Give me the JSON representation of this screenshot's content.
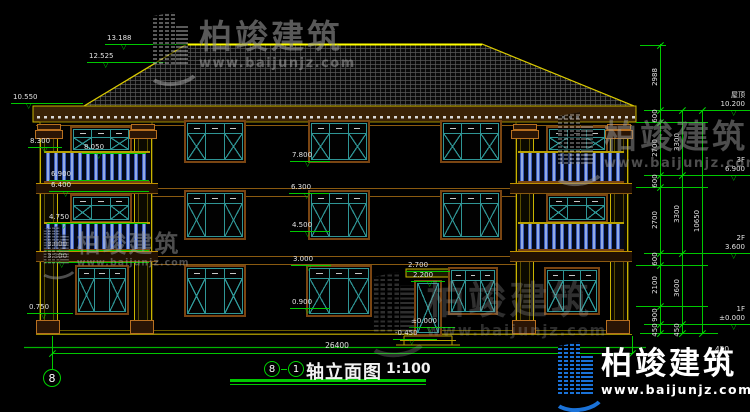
{
  "drawing": {
    "title_block": {
      "axis_start": "8",
      "axis_end": "1",
      "name": "轴立面图",
      "scale": "1:100"
    },
    "axis_bubble_left": "8",
    "watermark": {
      "brand": "柏竣建筑",
      "url": "www.baijunjz.com"
    },
    "brand_logo": {
      "brand": "柏竣建筑",
      "url": "www.baijunjz.com"
    },
    "colors": {
      "line_green": "#00c800",
      "line_yellow": "#c8b400",
      "frame_teal": "#2f9595",
      "frame_brown": "#7a4512",
      "baluster_blue": "#3a5cc0",
      "logo_blue": "#1a72d8"
    },
    "elevation_markers": [
      {
        "t": "13.188",
        "x": 107,
        "y": 44,
        "len": 82,
        "tx": 14
      },
      {
        "t": "12.525",
        "x": 89,
        "y": 62,
        "len": 78,
        "tx": 14
      },
      {
        "t": "10.550",
        "x": 13,
        "y": 103,
        "len": 72,
        "tx": 13
      },
      {
        "t": "8.300",
        "x": 30,
        "y": 147,
        "len": 34,
        "tx": 12
      },
      {
        "t": "8.050",
        "x": 84,
        "y": 153,
        "len": 64,
        "tx": 12
      },
      {
        "t": "6.900",
        "x": 51,
        "y": 180,
        "len": 100,
        "tx": 12
      },
      {
        "t": "6.400",
        "x": 51,
        "y": 191,
        "len": 100,
        "tx": 12
      },
      {
        "t": "4.750",
        "x": 49,
        "y": 223,
        "len": 100,
        "tx": 12
      },
      {
        "t": "3.600",
        "x": 47,
        "y": 250,
        "len": 104,
        "tx": 12
      },
      {
        "t": "3.100",
        "x": 47,
        "y": 262,
        "len": 104,
        "tx": 12
      },
      {
        "t": "0.750",
        "x": 29,
        "y": 313,
        "len": 46,
        "tx": 12
      },
      {
        "t": "7.800",
        "x": 292,
        "y": 161,
        "len": 40,
        "tx": 13
      },
      {
        "t": "6.300",
        "x": 291,
        "y": 193,
        "len": 40,
        "tx": 13
      },
      {
        "t": "4.500",
        "x": 292,
        "y": 231,
        "len": 40,
        "tx": 13
      },
      {
        "t": "3.000",
        "x": 293,
        "y": 265,
        "len": 40,
        "tx": 13
      },
      {
        "t": "0.900",
        "x": 292,
        "y": 308,
        "len": 40,
        "tx": 13
      },
      {
        "t": "2.700",
        "x": 408,
        "y": 271,
        "len": 44,
        "tx": 14
      },
      {
        "t": "2.200",
        "x": 413,
        "y": 281,
        "len": 34,
        "tx": 14
      },
      {
        "t": "±0.000",
        "x": 411,
        "y": 327,
        "len": 46,
        "tx": 16
      },
      {
        "t": "-0.450",
        "x": 395,
        "y": 339,
        "len": 44,
        "tx": 14
      }
    ],
    "level_markers": [
      {
        "name": "屋顶",
        "value": "10.200",
        "y": 110
      },
      {
        "name": "3F",
        "value": "6.900",
        "y": 175
      },
      {
        "name": "2F",
        "value": "3.600",
        "y": 253
      },
      {
        "name": "1F",
        "value": "±0.000",
        "y": 324
      }
    ],
    "vertical_dims": [
      {
        "t": "2988",
        "x": 655,
        "y": 77
      },
      {
        "t": "600",
        "x": 655,
        "y": 116
      },
      {
        "t": "2700",
        "x": 655,
        "y": 148
      },
      {
        "t": "600",
        "x": 655,
        "y": 181
      },
      {
        "t": "2700",
        "x": 655,
        "y": 220
      },
      {
        "t": "600",
        "x": 655,
        "y": 259
      },
      {
        "t": "2100",
        "x": 655,
        "y": 285
      },
      {
        "t": "900",
        "x": 655,
        "y": 315
      },
      {
        "t": "450",
        "x": 655,
        "y": 330
      },
      {
        "t": "3300",
        "x": 677,
        "y": 142
      },
      {
        "t": "3300",
        "x": 677,
        "y": 214
      },
      {
        "t": "3600",
        "x": 677,
        "y": 288
      },
      {
        "t": "450",
        "x": 677,
        "y": 330
      },
      {
        "t": "10650",
        "x": 697,
        "y": 221
      }
    ],
    "bottom_dims": [
      {
        "t": "26400",
        "x": 337,
        "y": 341
      },
      {
        "t": "450",
        "x": 722,
        "y": 345
      }
    ]
  }
}
